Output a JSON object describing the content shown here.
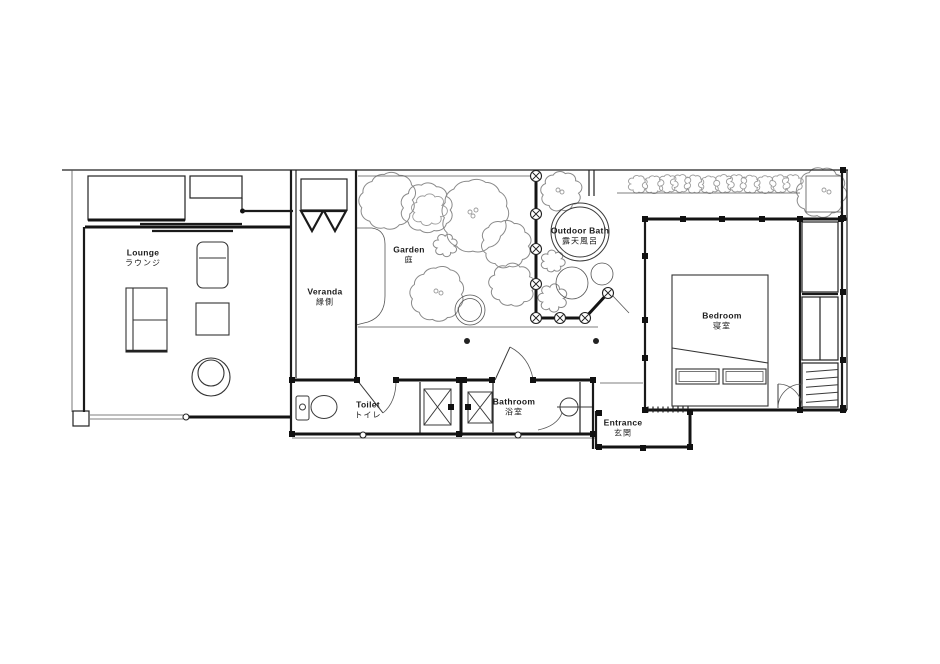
{
  "page": {
    "background": "#ffffff",
    "description": "Architectural floor plan of a Japanese ryokan guest suite"
  },
  "rooms": {
    "lounge": {
      "en": "Lounge",
      "ja": "ラウンジ"
    },
    "veranda": {
      "en": "Veranda",
      "ja": "縁側"
    },
    "garden": {
      "en": "Garden",
      "ja": "庭"
    },
    "outdoor_bath": {
      "en": "Outdoor Bath",
      "ja": "露天風呂"
    },
    "bedroom": {
      "en": "Bedroom",
      "ja": "寝室"
    },
    "toilet": {
      "en": "Toilet",
      "ja": "トイレ"
    },
    "bathroom": {
      "en": "Bathroom",
      "ja": "浴室"
    },
    "entrance": {
      "en": "Entrance",
      "ja": "玄関"
    }
  },
  "colors": {
    "line": "#141414",
    "vegetation": "#8a8a8a",
    "background": "#ffffff"
  }
}
